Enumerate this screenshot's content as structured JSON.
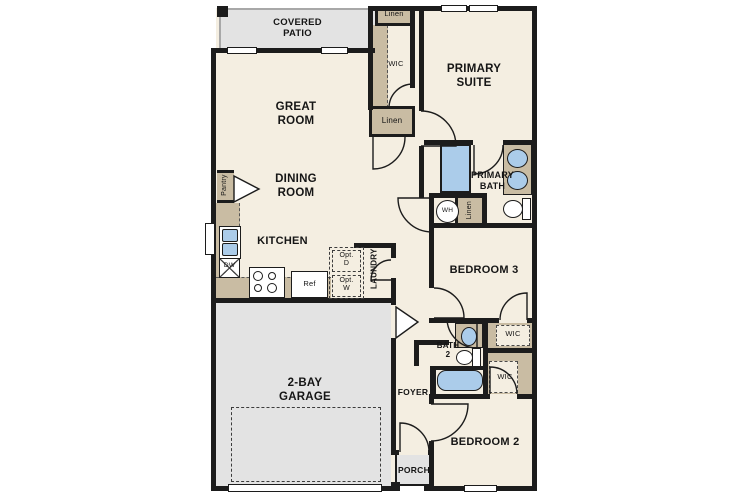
{
  "rooms": {
    "covered_patio": {
      "line1": "COVERED",
      "line2": "PATIO"
    },
    "great_room": {
      "line1": "GREAT",
      "line2": "ROOM"
    },
    "dining_room": {
      "line1": "DINING",
      "line2": "ROOM"
    },
    "kitchen": {
      "label": "KITCHEN"
    },
    "primary_suite": {
      "line1": "PRIMARY",
      "line2": "SUITE"
    },
    "primary_bath": {
      "line1": "PRIMARY",
      "line2": "BATH"
    },
    "bedroom3": {
      "label": "BEDROOM 3"
    },
    "bedroom2": {
      "label": "BEDROOM 2"
    },
    "garage": {
      "line1": "2-BAY",
      "line2": "GARAGE"
    },
    "laundry": {
      "label": "LAUNDRY"
    },
    "foyer": {
      "label": "FOYER"
    },
    "porch": {
      "label": "PORCH"
    },
    "bath2": {
      "line1": "BATH",
      "line2": "2"
    }
  },
  "closets": {
    "linen_top": "Linen",
    "wic_top": "WIC",
    "linen_hall": "Linen",
    "linen_bath": "Linen",
    "pantry": "Pantry",
    "wic_bedroom3": "WIC",
    "wic_bedroom2": "WIC"
  },
  "fixtures": {
    "water_heater": "WH",
    "dishwasher": "DW",
    "refrigerator": "Ref",
    "opt_dryer": {
      "line1": "Opt.",
      "line2": "D"
    },
    "opt_washer": {
      "line1": "Opt.",
      "line2": "W"
    }
  },
  "colors": {
    "wall": "#1c1c1c",
    "floor": "#f4eee1",
    "outdoor": "#e3e3e3",
    "casework": "#c9bca3",
    "fixture": "#abccea"
  }
}
